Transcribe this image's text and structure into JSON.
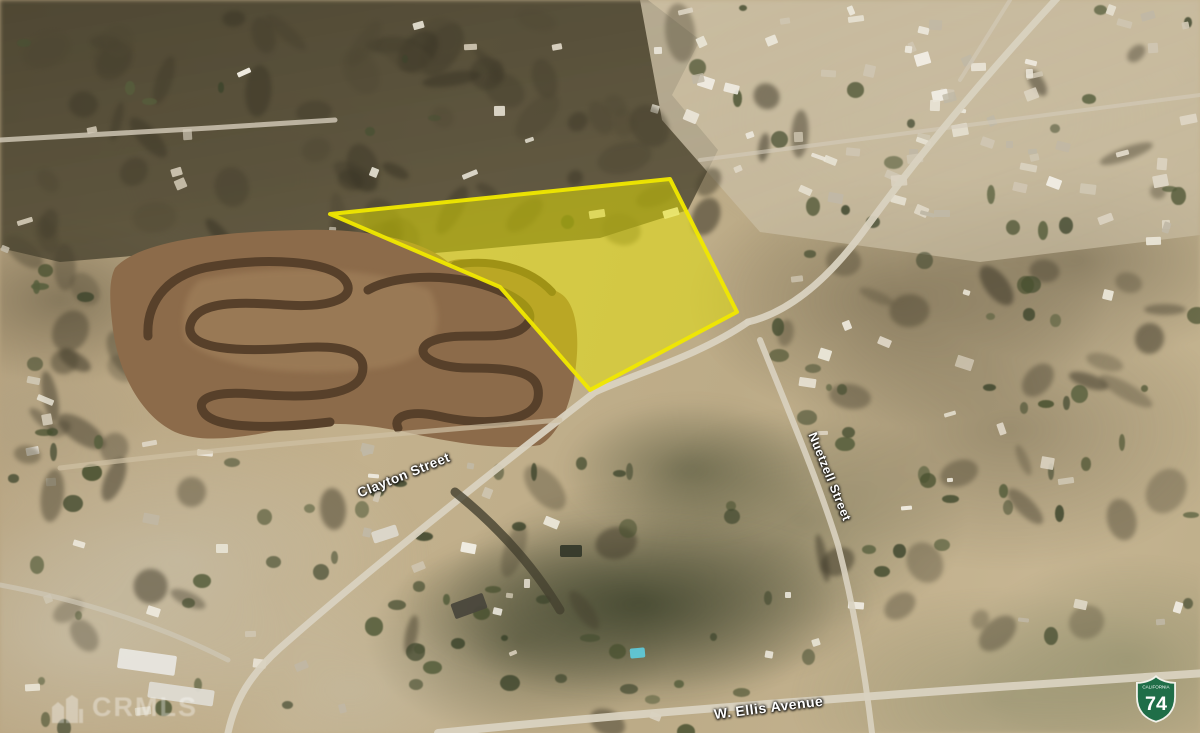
{
  "streets": {
    "clayton": "Clayton Street",
    "nuetzell": "Nuetzell Street",
    "ellis": "W. Ellis Avenue"
  },
  "highway_shield": {
    "caption": "CALIFORNIA",
    "route": "74",
    "color": "#1f6e48"
  },
  "watermark": {
    "text": "CRMLS"
  },
  "parcel": {
    "points": "330,214 670,179 737,312 590,390 500,287",
    "fill": "#e8e400",
    "stroke": "#f0e800"
  }
}
